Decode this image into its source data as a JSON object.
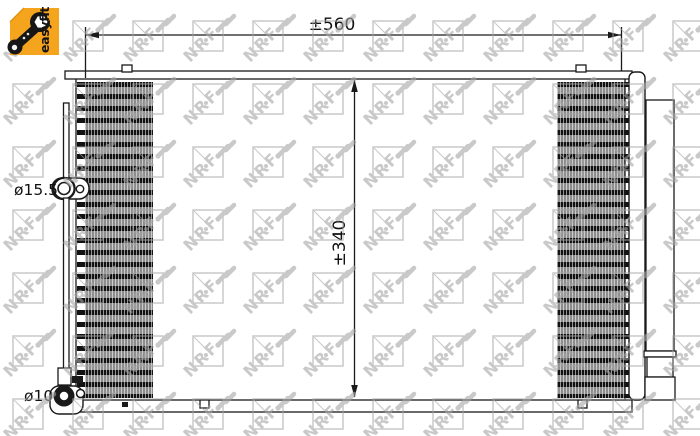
{
  "badge": {
    "label": "easyfit"
  },
  "watermark": {
    "brand": "NRF"
  },
  "drawing": {
    "width_dim": "±560",
    "height_dim": "±340",
    "inlet_diameter": "ø15.5",
    "outlet_diameter": "ø10"
  },
  "colors": {
    "badge_orange": "#F5A41E",
    "line_black": "#1A1A1A",
    "watermark_gray": "#A6A6A6"
  }
}
